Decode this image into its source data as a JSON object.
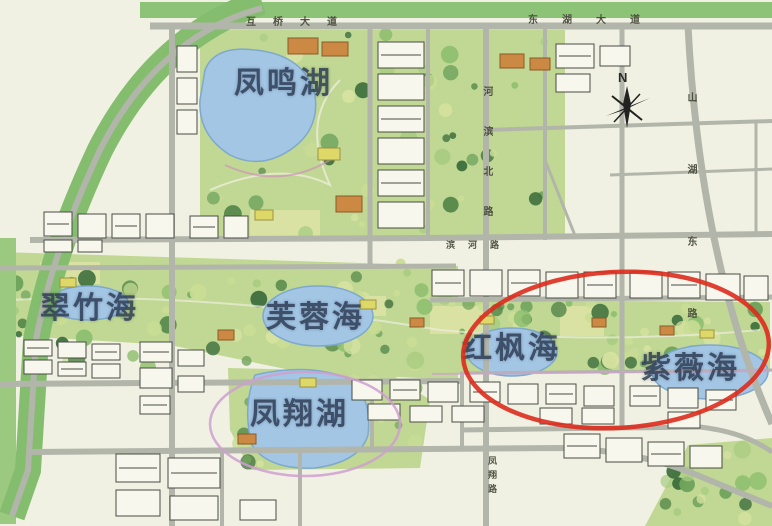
{
  "map": {
    "type": "urban-master-plan",
    "area_labels": {
      "fengming_lake": "凤鸣湖",
      "cuizhu_sea": "翠竹海",
      "furong_sea": "芙蓉海",
      "hongfeng_sea": "红枫海",
      "ziwei_sea": "紫薇海",
      "fengxiang_lake": "凤翔湖"
    },
    "road_labels": {
      "top_left_avenue": "互桥大道",
      "top_right_avenue": "东湖大道",
      "mid_vertical_road": "河滨北路",
      "right_vertical_road": "山湖东路",
      "center_small_road": "滨河路",
      "bottom_vertical_road": "凤翔路"
    },
    "compass": {
      "north": "N"
    },
    "highlight": {
      "shape": "ellipse",
      "meaning": "red circle around 红枫海 and 紫薇海",
      "color": "#dd2b1c"
    },
    "colors": {
      "background": "#f0f1e2",
      "road": "#b2b5aa",
      "green_band": "#85bd6f",
      "park_base": "#c0d893",
      "water": "#a3c6e4",
      "water_edge": "#7ea9cc",
      "building_fill": "#f7f7ed",
      "building_stroke": "#4a4d45",
      "orange_building": "#cc8944",
      "yellow_building": "#ddd868",
      "label_text": "#2b3a52",
      "pink_outline": "#cf9fd0",
      "highlight_red": "#dd2b1c"
    }
  }
}
